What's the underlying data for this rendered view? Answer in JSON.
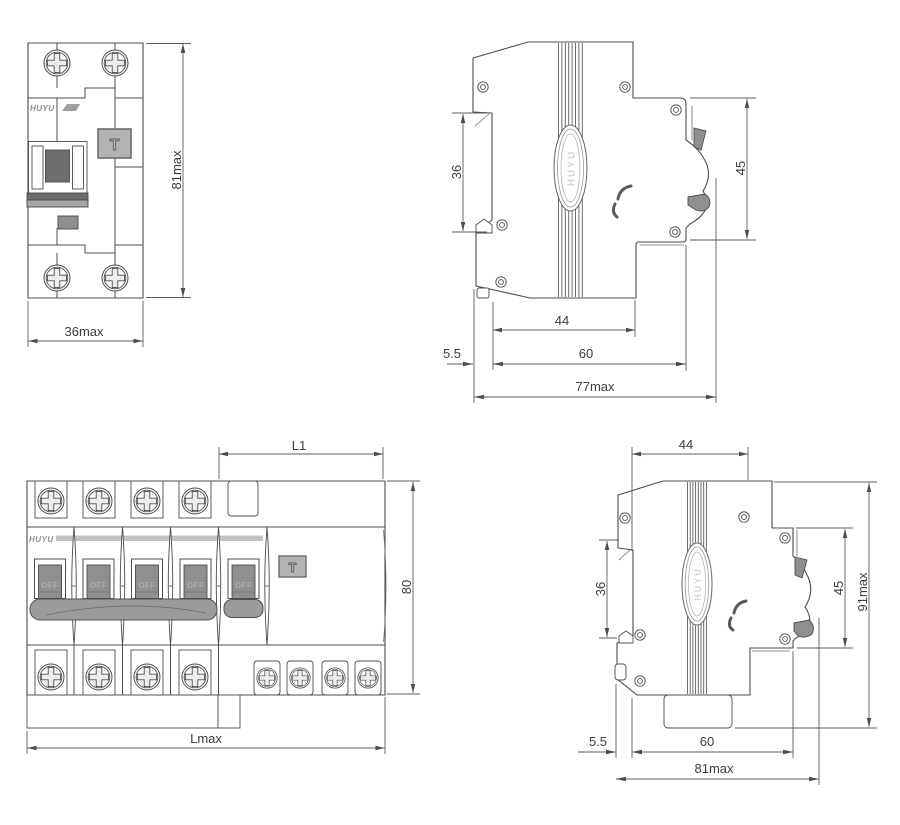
{
  "brand": "HUYU",
  "views": {
    "v1": {
      "h": "81max",
      "w": "36max",
      "t": "T"
    },
    "v2": {
      "rail": "36",
      "front": "45",
      "a": "44",
      "b": "60",
      "gap": "5.5",
      "total": "77max"
    },
    "v3": {
      "l1": "L1",
      "h": "80",
      "total": "Lmax",
      "off": "OFF",
      "t": "T"
    },
    "v4": {
      "top": "44",
      "rail": "36",
      "front": "45",
      "h": "91max",
      "gap": "5.5",
      "b": "60",
      "total": "81max"
    }
  },
  "colors": {
    "line": "#4c4c4c",
    "dim_text": "#3c3c3c",
    "handle_gray": "#8f8f8f",
    "button_gray": "#b3b3b3",
    "bar_gray": "#c2c2c2"
  }
}
